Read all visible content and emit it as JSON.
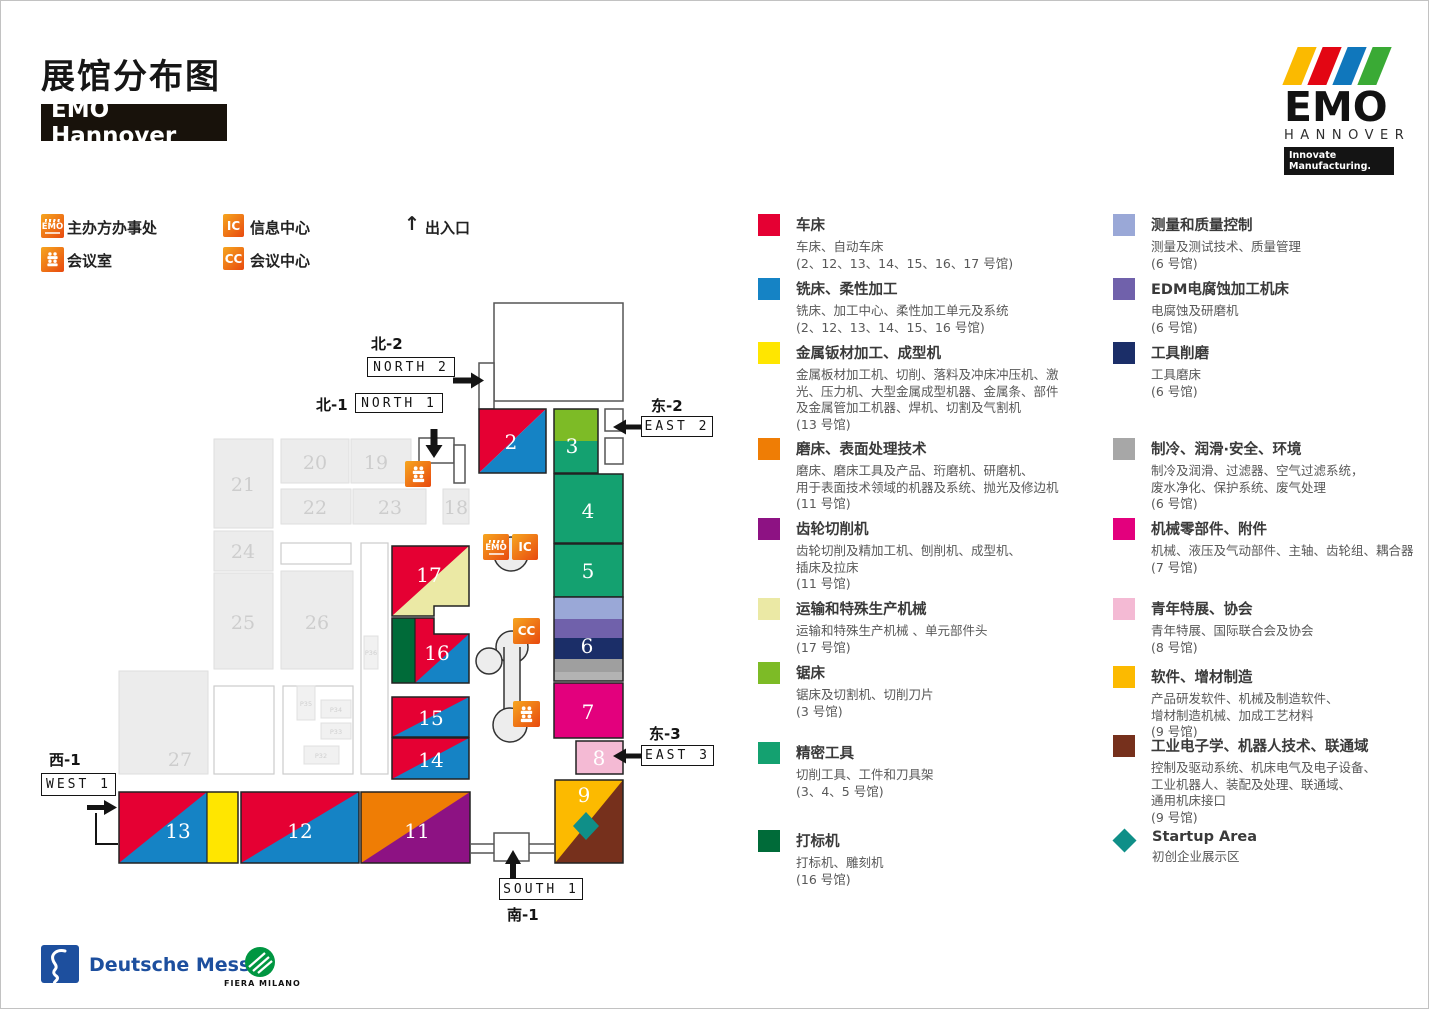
{
  "page": {
    "title": "展馆分布图",
    "subtitle": "EMO Hannover"
  },
  "brand": {
    "emo": "EMO",
    "hannover": "HANNOVER",
    "tagline": "Innovate Manufacturing."
  },
  "key": {
    "organizer": "主办方办事处",
    "meeting_room": "会议室",
    "info_center": "信息中心",
    "conference_center": "会议中心",
    "entrance": "出入口",
    "entrance_arrow": "↑",
    "ic": "IC",
    "cc": "CC",
    "emo": "EMO"
  },
  "directions": {
    "north2": {
      "cn": "北-2",
      "en": "NORTH 2"
    },
    "north1": {
      "cn": "北-1",
      "en": "NORTH 1"
    },
    "east2": {
      "cn": "东-2",
      "en": "EAST 2"
    },
    "east3": {
      "cn": "东-3",
      "en": "EAST 3"
    },
    "west1": {
      "cn": "西-1",
      "en": "WEST 1"
    },
    "south1": {
      "cn": "南-1",
      "en": "SOUTH 1"
    }
  },
  "halls": {
    "h2": "2",
    "h3": "3",
    "h4": "4",
    "h5": "5",
    "h6": "6",
    "h7": "7",
    "h8": "8",
    "h9": "9",
    "h11": "11",
    "h12": "12",
    "h13": "13",
    "h14": "14",
    "h15": "15",
    "h16": "16",
    "h17": "17",
    "h18": "18",
    "h19": "19",
    "h20": "20",
    "h21": "21",
    "h22": "22",
    "h23": "23",
    "h24": "24",
    "h25": "25",
    "h26": "26",
    "h27": "27",
    "p32": "P32",
    "p33": "P33",
    "p34": "P34",
    "p35": "P35",
    "p36": "P36"
  },
  "colors": {
    "lathe_red": "#e50033",
    "milling_blue": "#1583c5",
    "sheet_yellow": "#ffe600",
    "grinding_orange": "#ef7d05",
    "gear_purple": "#8d1283",
    "transport_cream": "#ebe9a5",
    "saw_green": "#7dbb26",
    "precision_green": "#14a170",
    "marking_green": "#006b39",
    "measuring_blue": "#9aa8d7",
    "edm_purple": "#7061ab",
    "toolgrind_navy": "#1b2e68",
    "cooling_gray": "#a7a7a7",
    "components_magenta": "#e3007d",
    "youth_pink": "#f4bad4",
    "software_gold": "#fcba00",
    "robotics_brown": "#76301c",
    "startup_teal": "#0f8f88"
  },
  "legend_left": [
    {
      "name": "车床",
      "desc": [
        "车床、自动车床"
      ],
      "halls": "(2、12、13、14、15、16、17 号馆)",
      "color": "#e50033"
    },
    {
      "name": "铣床、柔性加工",
      "desc": [
        "铣床、加工中心、柔性加工单元及系统"
      ],
      "halls": "(2、12、13、14、15、16 号馆)",
      "color": "#1583c5"
    },
    {
      "name": "金属钣材加工、成型机",
      "desc": [
        "金属板材加工机、切削、落料及冲床冲压机、激",
        "光、压力机、大型金属成型机器、金属条、部件",
        "及金属管加工机器、焊机、切割及气割机"
      ],
      "halls": "(13 号馆)",
      "color": "#ffe600"
    },
    {
      "name": "磨床、表面处理技术",
      "desc": [
        "磨床、磨床工具及产品、珩磨机、研磨机、",
        "用于表面技术领域的机器及系统、抛光及修边机"
      ],
      "halls": "(11 号馆)",
      "color": "#ef7d05"
    },
    {
      "name": "齿轮切削机",
      "desc": [
        "齿轮切削及精加工机、刨削机、成型机、",
        "插床及拉床"
      ],
      "halls": "(11 号馆)",
      "color": "#8d1283"
    },
    {
      "name": "运输和特殊生产机械",
      "desc": [
        "运输和特殊生产机械 、单元部件头"
      ],
      "halls": "(17 号馆)",
      "color": "#ebe9a5"
    },
    {
      "name": "锯床",
      "desc": [
        "锯床及切割机、切削刀片"
      ],
      "halls": "(3 号馆)",
      "color": "#7dbb26"
    },
    {
      "name": "精密工具",
      "desc": [
        "切削工具、工件和刀具架"
      ],
      "halls": "(3、4、5 号馆)",
      "color": "#14a170"
    },
    {
      "name": "打标机",
      "desc": [
        "打标机、雕刻机"
      ],
      "halls": "(16 号馆)",
      "color": "#006b39"
    }
  ],
  "legend_right": [
    {
      "name": "测量和质量控制",
      "desc": [
        "测量及测试技术、质量管理"
      ],
      "halls": "(6 号馆)",
      "color": "#9aa8d7"
    },
    {
      "name": "EDM电腐蚀加工机床",
      "desc": [
        "电腐蚀及研磨机"
      ],
      "halls": "(6 号馆)",
      "color": "#7061ab"
    },
    {
      "name": "工具削磨",
      "desc": [
        "工具磨床"
      ],
      "halls": "(6 号馆)",
      "color": "#1b2e68"
    },
    {
      "name": "制冷、润滑·安全、环境",
      "desc": [
        "制冷及润滑、过滤器、空气过滤系统，",
        "废水净化、保护系统、废气处理"
      ],
      "halls": "(6 号馆)",
      "color": "#a7a7a7"
    },
    {
      "name": "机械零部件、附件",
      "desc": [
        "机械、液压及气动部件、主轴、齿轮组、耦合器"
      ],
      "halls": "(7 号馆)",
      "color": "#e3007d"
    },
    {
      "name": "青年特展、协会",
      "desc": [
        "青年特展、国际联合会及协会"
      ],
      "halls": "(8 号馆)",
      "color": "#f4bad4"
    },
    {
      "name": "软件、增材制造",
      "desc": [
        "产品研发软件、机械及制造软件、",
        "增材制造机械、加成工艺材料"
      ],
      "halls": "(9 号馆)",
      "color": "#fcba00"
    },
    {
      "name": "工业电子学、机器人技术、联通域",
      "desc": [
        "控制及驱动系统、机床电气及电子设备、",
        "工业机器人、装配及处理、联通域、",
        "通用机床接口"
      ],
      "halls": "(9 号馆)",
      "color": "#76301c"
    },
    {
      "name": "Startup Area",
      "desc": [
        "初创企业展示区"
      ],
      "halls": "",
      "color": "#0f8f88"
    }
  ],
  "footer": {
    "deutsche_messe": "Deutsche Messe",
    "fiera_milano": "FIERA MILANO"
  }
}
